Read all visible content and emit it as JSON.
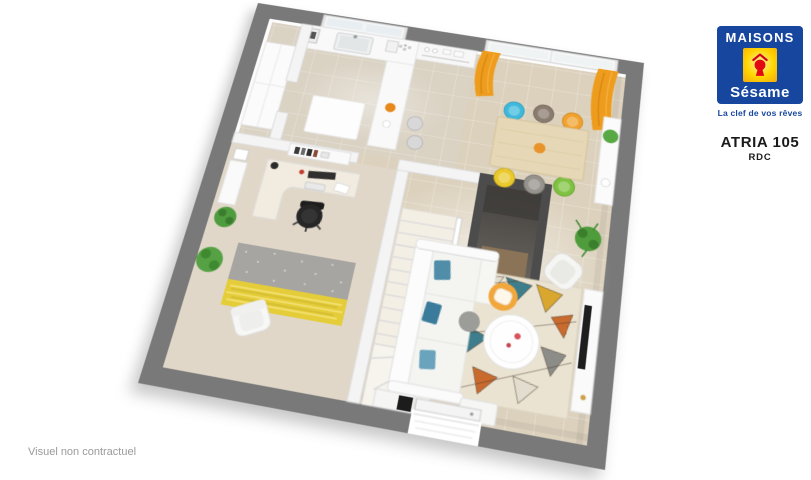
{
  "logo": {
    "brand_line1": "MAISONS",
    "brand_line2": "Sésame",
    "tagline": "La clef de vos rêves",
    "colors": {
      "blue": "#17469e",
      "yellow": "#ffd400",
      "red": "#e30613"
    }
  },
  "plan": {
    "model_name": "ATRIA 105",
    "floor_label": "RDC"
  },
  "disclaimer": "Visuel non contractuel",
  "floorplan_palette": {
    "outer_wall_gray": "#797979",
    "storage_room_gray": "#4c4c4c",
    "floor_beige": "#dcd1bd",
    "office_carpet": "#e0d7c8",
    "inner_wall_white": "#f4f4f4",
    "curtain_orange": "#ee9c1d",
    "dining_table_wood": "#e6d8b6",
    "dining_chairs": [
      "#3eb9dc",
      "#8b7c70",
      "#f0a22e",
      "#e9c92c",
      "#96928c",
      "#7fc241"
    ],
    "sofa_white": "#f4f4f1",
    "pillow_blue": "#4f8da8",
    "pouf_orange": "#f2a73c",
    "living_rug_base": "#eae3d2",
    "living_rug_accents": [
      "#c96a2e",
      "#3e7e8c",
      "#d9a72e",
      "#8c8c88"
    ],
    "office_rug_gray": "#a7a5a1",
    "office_rug_yellow": "#e4cd39",
    "plant_green": "#4e9c3c"
  }
}
